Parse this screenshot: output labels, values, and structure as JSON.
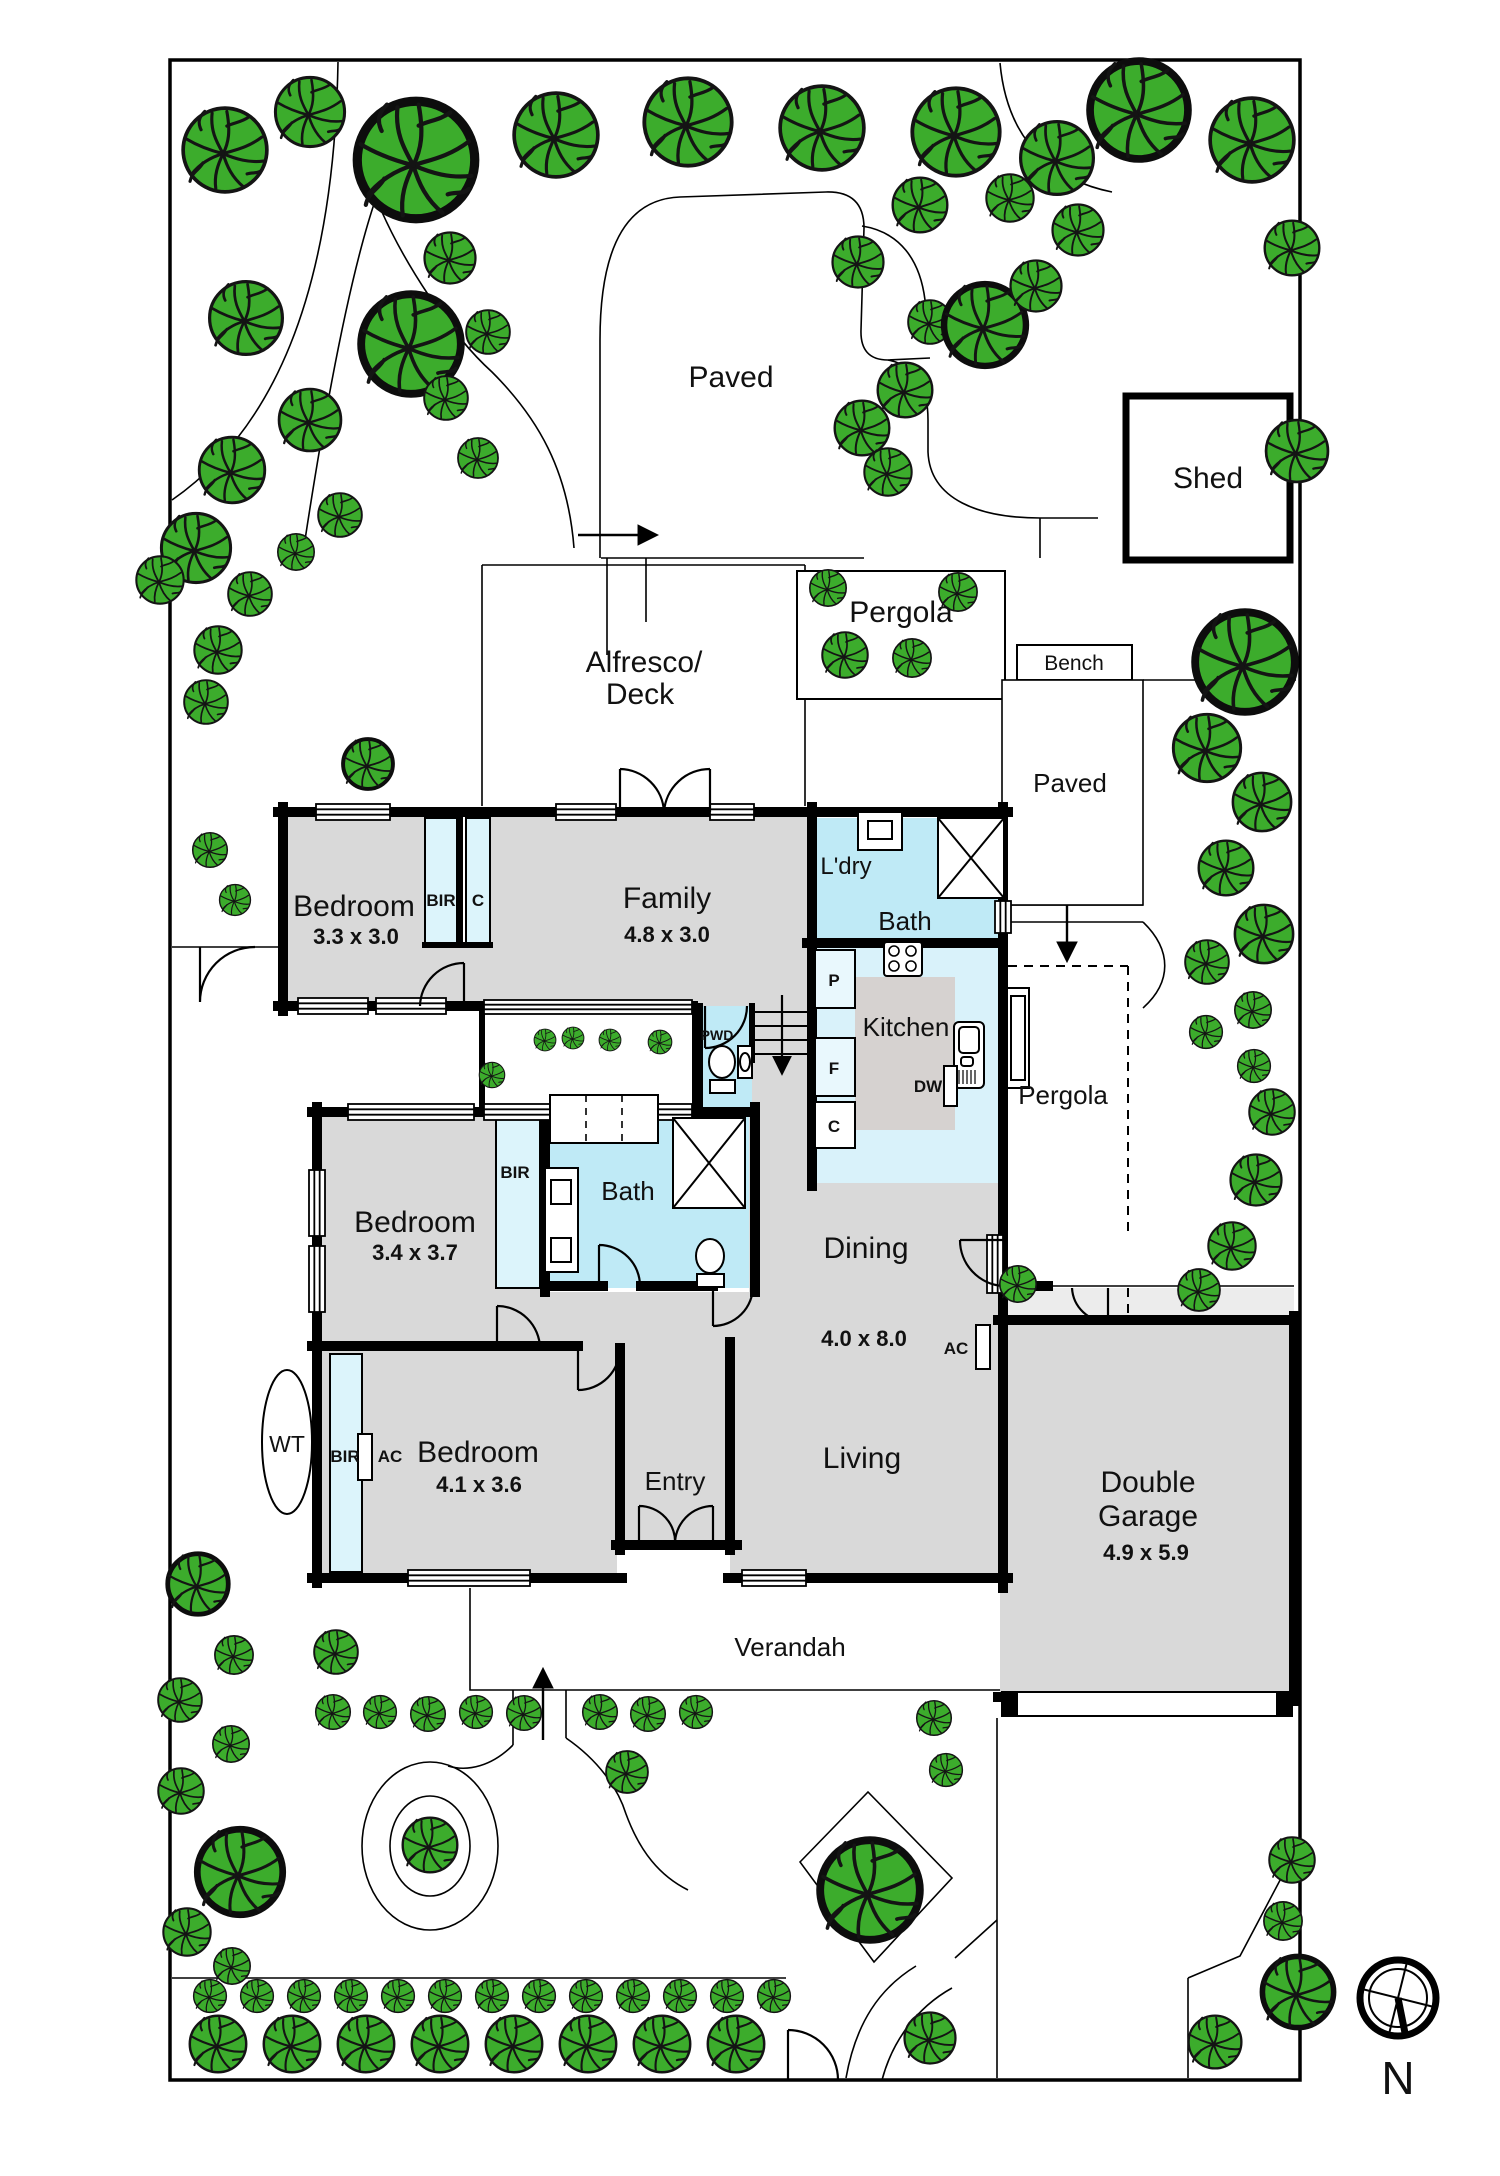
{
  "plan": {
    "areas": {
      "paved_top": "Paved",
      "shed": "Shed",
      "pergola_top": "Pergola",
      "bench": "Bench",
      "paved_right": "Paved",
      "alfresco_line1": "Alfresco/",
      "alfresco_line2": "Deck",
      "pergola_right": "Pergola",
      "verandah": "Verandah"
    },
    "rooms": {
      "bedroom1": {
        "name": "Bedroom",
        "dims": "3.3 x 3.0"
      },
      "family": {
        "name": "Family",
        "dims": "4.8 x 3.0"
      },
      "laundry": {
        "name": "L'dry"
      },
      "bath_rear": {
        "name": "Bath"
      },
      "kitchen": {
        "name": "Kitchen"
      },
      "bedroom2": {
        "name": "Bedroom",
        "dims": "3.4 x 3.7"
      },
      "bath_main": {
        "name": "Bath"
      },
      "powder": {
        "name": "PWD"
      },
      "dining": {
        "name": "Dining"
      },
      "dining_living": {
        "dims": "4.0 x 8.0"
      },
      "living": {
        "name": "Living"
      },
      "bedroom3": {
        "name": "Bedroom",
        "dims": "4.1 x 3.6"
      },
      "entry": {
        "name": "Entry"
      },
      "garage": {
        "name_line1": "Double",
        "name_line2": "Garage",
        "dims": "4.9 x 5.9"
      }
    },
    "fixtures": {
      "bir1": "BIR",
      "c1": "C",
      "pantry": "P",
      "fridge": "F",
      "cupboard": "C",
      "dishwasher": "DW",
      "bir2": "BIR",
      "bir3": "BIR",
      "ac_bedroom": "AC",
      "ac_living": "AC",
      "water_tank": "WT"
    },
    "compass": {
      "north_label": "N"
    },
    "colors": {
      "tree_green": "#3CAC2C",
      "room_grey": "#D9D9D9",
      "wet_area_blue": "#BFEAF6",
      "closet_blue": "#DCF4FB",
      "wall_black": "#000000"
    }
  }
}
